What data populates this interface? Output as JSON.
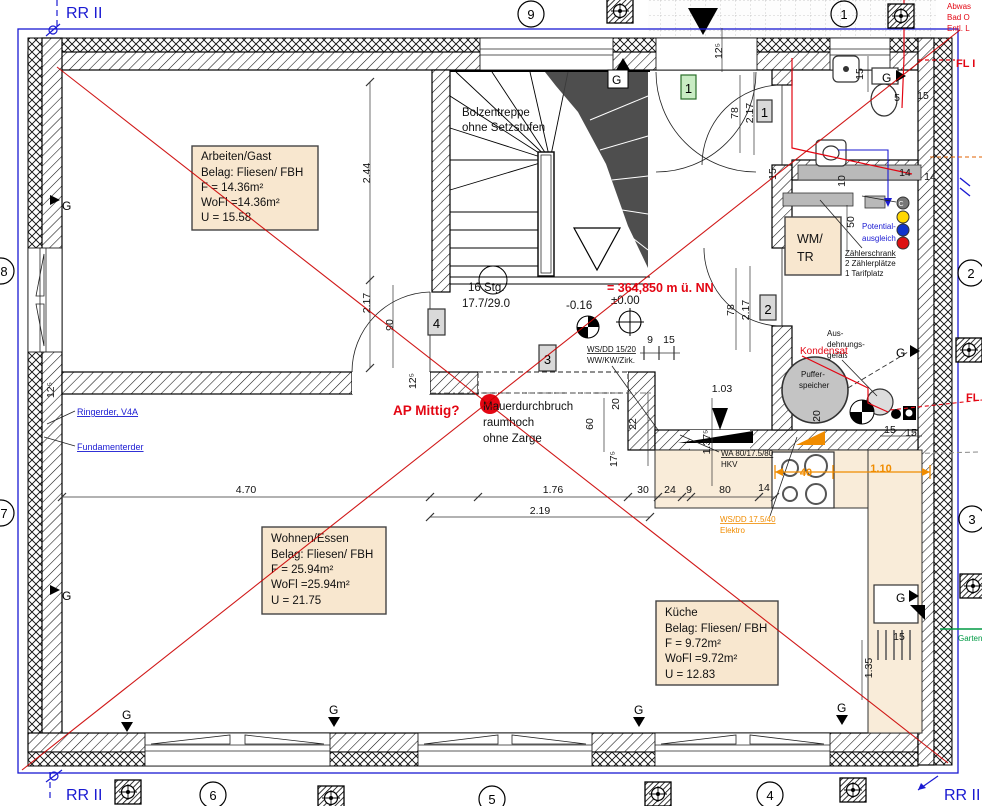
{
  "colors": {
    "accent_blue": "#1a1ad2",
    "accent_red": "#e30613",
    "accent_orange": "#f08c00",
    "accent_green": "#009a44",
    "label_bg": "#f8e7cf",
    "gray_fill": "#b9b9b9"
  },
  "rr_label": "RR II",
  "g_label": "G",
  "axes": {
    "a1": "1",
    "a2": "2",
    "a3": "3",
    "a4": "4",
    "a5": "5",
    "a6": "6",
    "a7": "7",
    "a8": "8",
    "a9": "9"
  },
  "boxes": {
    "b1": "1",
    "b2": "2",
    "b3": "3",
    "b4": "4",
    "entry": "1"
  },
  "rooms": {
    "arbeiten": {
      "name": "Arbeiten/Gast",
      "belag": "Belag: Fliesen/ FBH",
      "f": "F = 14.36m²",
      "wofl": "WoFl =14.36m²",
      "u": "U = 15.58"
    },
    "wohnen": {
      "name": "Wohnen/Essen",
      "belag": "Belag: Fliesen/ FBH",
      "f": "F = 25.94m²",
      "wofl": "WoFl =25.94m²",
      "u": "U = 21.75"
    },
    "kueche": {
      "name": "Küche",
      "belag": "Belag: Fliesen/ FBH",
      "f": "F = 9.72m²",
      "wofl": "WoFl =9.72m²",
      "u": "U = 12.83"
    }
  },
  "stair": {
    "s1": "Bolzentreppe",
    "s2": "ohne Setzstufen",
    "s3": "16 Stg.",
    "s4": "17.7/29.0"
  },
  "levels": {
    "nn": "= 364,850 m ü. NN",
    "zero": "±0.00",
    "minus": "-0.16"
  },
  "notes": {
    "ap": "AP Mittig?",
    "durch1": "Mauerdurchbruch",
    "durch2": "raumhoch",
    "durch3": "ohne Zarge",
    "wm1": "WM/",
    "wm2": "TR",
    "pot1": "Potential-",
    "pot2": "ausgleich",
    "z1": "Zählerschrank",
    "z2": "2 Zählerplätze",
    "z3": "1 Tarifplatz",
    "ws15a": "WS/DD 15/20",
    "ws15b": "WW/KW/Zirk.",
    "wa1": "WA 80/17.5/80",
    "wa2": "HKV",
    "ws17a": "WS/DD 17.5/40",
    "ws17b": "Elektro",
    "puf1": "Puffer-",
    "puf2": "speicher",
    "aus1": "Aus-",
    "aus2": "dehnungs-",
    "aus3": "gefäß",
    "kond": "Kondensat",
    "ring": "Ringerder, V4A",
    "fund": "Fundamenterder",
    "fl1": "FL I",
    "fl2": "FL",
    "tr1": "Abwas",
    "tr2": "Bad O",
    "tr3": "Entl. L",
    "garten": "Garten",
    "c": "C"
  },
  "dims": {
    "d1": "2.44",
    "d2": "2.17",
    "d3": "90",
    "d4": "12⁵",
    "d5": "12⁵",
    "d6": "78",
    "d7": "2.17",
    "d8": "1.37⁵",
    "d9": "78",
    "d10": "2.17",
    "d11": "9",
    "d12": "15",
    "d13": "1.03",
    "d14": "60",
    "d15": "20",
    "d16": "22",
    "d17": "17⁵",
    "d18": "4.70",
    "d19": "1.76",
    "d20": "2.19",
    "d21": "30",
    "d22": "24",
    "d23": "9",
    "d24": "80",
    "d25": "14",
    "d26": "40",
    "d27": "1.10",
    "d28": "15",
    "d29": "5",
    "d30": "15",
    "d31": "15",
    "d32": "10",
    "d33": "14",
    "d34": "14",
    "d35": "50",
    "d36": "20",
    "d37": "15",
    "d38": "15",
    "d39": "15",
    "d40": "1.35",
    "d41": "12⁵"
  }
}
